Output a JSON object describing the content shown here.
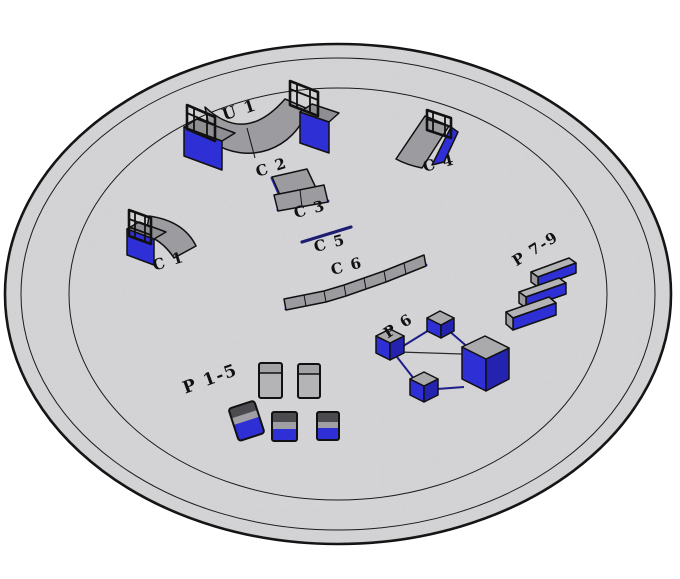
{
  "diagram": {
    "type": "skatepark-layout-3d-render",
    "labels": {
      "u1": "U 1",
      "c1": "C 1",
      "c2": "C 2",
      "c3": "C 3",
      "c4": "C 4",
      "c5": "C 5",
      "c6": "C 6",
      "p1_5": "P 1-5",
      "p6": "P 6",
      "p7_9": "P 7-9"
    },
    "colors": {
      "background": "#ffffff",
      "pad_fill": "#d6d6d8",
      "ring_stroke": "#1a1a1a",
      "ramp_gray": "#9c9ca0",
      "deck_gray": "#aaaaad",
      "slab_gray": "#b4b4b7",
      "dark_gray": "#4b4b4f",
      "obstacle_blue": "#2f2fd6",
      "obstacle_blue_dark": "#2323b0",
      "rail_navy": "#1e1e8a",
      "label_color": "#111111"
    }
  }
}
